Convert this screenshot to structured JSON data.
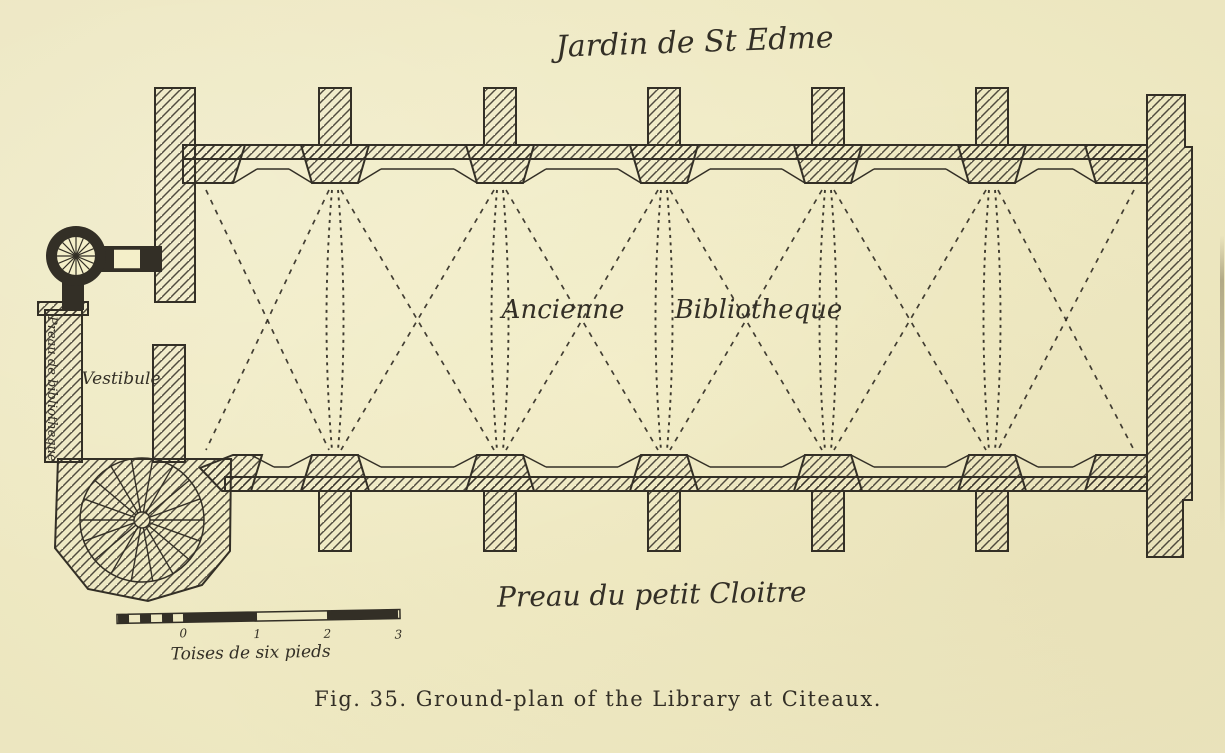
{
  "figure": {
    "caption": "Fig. 35.  Ground-plan of the Library at Citeaux.",
    "plan_labels": {
      "garden": "Jardin de St Edme",
      "library": "Ancienne Bibliotheque",
      "vestibule": "Vestibule",
      "cloister": "Preau du petit Cloitre",
      "passage": "Preau de bibliotheque"
    },
    "scale_bar": {
      "unit_label": "Toises de six pieds",
      "ticks": [
        "0",
        "1",
        "2",
        "3"
      ]
    },
    "colors": {
      "paper": "#f4efc9",
      "ink": "#332f26"
    }
  }
}
